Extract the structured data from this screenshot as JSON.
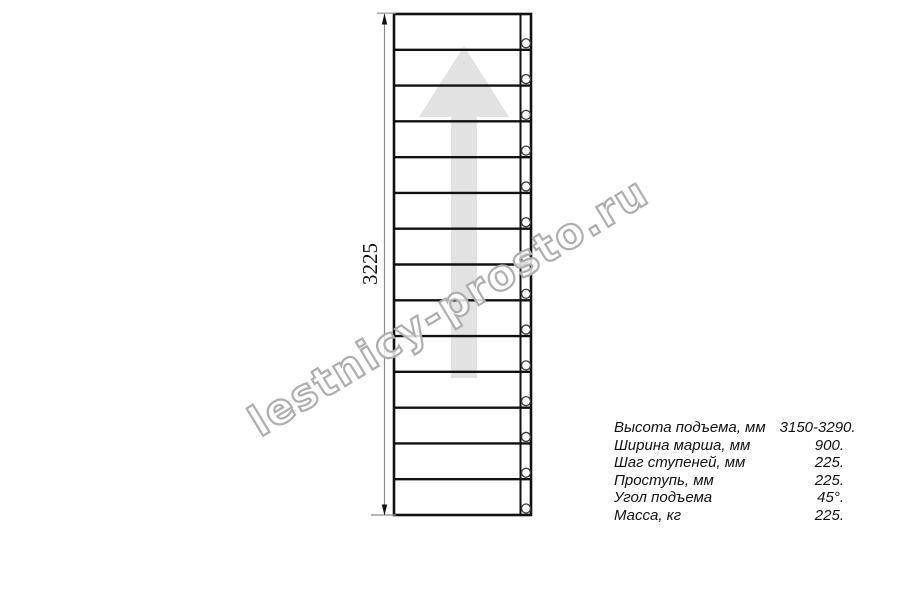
{
  "page": {
    "background": "#ffffff"
  },
  "watermark": {
    "text": "lestnicy-prosto.ru",
    "outline_color": "#aeaeae",
    "fill_color": "#ffffff"
  },
  "drawing": {
    "type": "staircase-plan-top-view",
    "treads": 14,
    "dimension": {
      "label": "3225"
    },
    "direction_arrow": {
      "direction": "up",
      "color": "#e2e2e2"
    },
    "line_color": "#111111",
    "dim_color": "#8c8c8c"
  },
  "specs": {
    "rows": [
      {
        "label": "Высота подъема, мм",
        "value": "3150-3290."
      },
      {
        "label": "Ширина марша, мм",
        "value": "900."
      },
      {
        "label": "Шаг ступеней, мм",
        "value": "225."
      },
      {
        "label": "Проступь, мм",
        "value": "225."
      },
      {
        "label": "Угол подъема",
        "value": "45°."
      },
      {
        "label": "Масса, кг",
        "value": "225."
      }
    ]
  }
}
